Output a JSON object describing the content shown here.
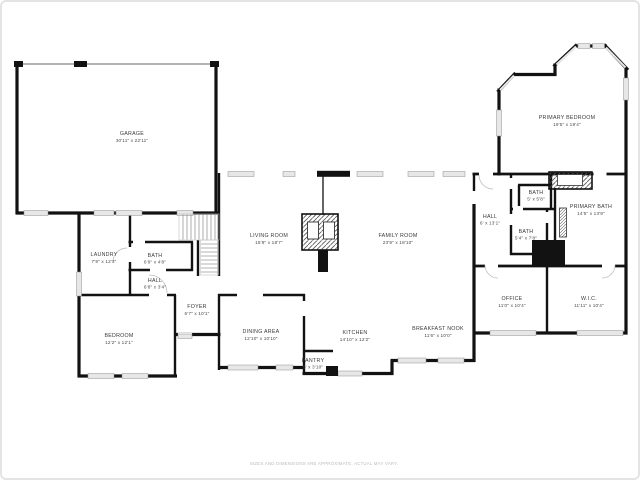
{
  "palette": {
    "wall": "#121212",
    "window_fill": "#e7e7e7",
    "window_stroke": "#8f8f8f",
    "label": "#3a3a3a",
    "footer": "#bcbcbc",
    "background": "#ffffff"
  },
  "rooms": [
    {
      "name": "GARAGE",
      "dims": "30'11\" x 22'11\""
    },
    {
      "name": "LIVING ROOM",
      "dims": "15'9\" x 18'7\""
    },
    {
      "name": "FAMILY ROOM",
      "dims": "23'9\" x 18'10\""
    },
    {
      "name": "PRIMARY BEDROOM",
      "dims": "19'5\" x 19'4\""
    },
    {
      "name": "BATH",
      "dims": "5' x 5'8\""
    },
    {
      "name": "PRIMARY BATH",
      "dims": "14'5\" x 13'9\""
    },
    {
      "name": "HALL",
      "dims": "6' x 13'1\""
    },
    {
      "name": "BATH",
      "dims": "5'4\" x 7'8\""
    },
    {
      "name": "OFFICE",
      "dims": "11'0\" x 10'4\""
    },
    {
      "name": "W.I.C.",
      "dims": "11'11\" x 10'4\""
    },
    {
      "name": "LAUNDRY",
      "dims": "7'9\" x 12'3\""
    },
    {
      "name": "BATH",
      "dims": "6'9\" x 4'8\""
    },
    {
      "name": "HALL",
      "dims": "6'8\" x 3'4\""
    },
    {
      "name": "FOYER",
      "dims": "6'7\" x 10'1\""
    },
    {
      "name": "BEDROOM",
      "dims": "12'2\" x 12'1\""
    },
    {
      "name": "DINING AREA",
      "dims": "12'10\" x 10'10\""
    },
    {
      "name": "KITCHEN",
      "dims": "14'10\" x 12'2\""
    },
    {
      "name": "BREAKFAST NOOK",
      "dims": "11'6\" x 10'0\""
    },
    {
      "name": "PANTRY",
      "dims": "5' x 3'10\""
    }
  ],
  "footer": {
    "disclaimer": "SIZES AND DIMENSIONS ARE APPROXIMATE, ACTUAL MAY VARY."
  }
}
